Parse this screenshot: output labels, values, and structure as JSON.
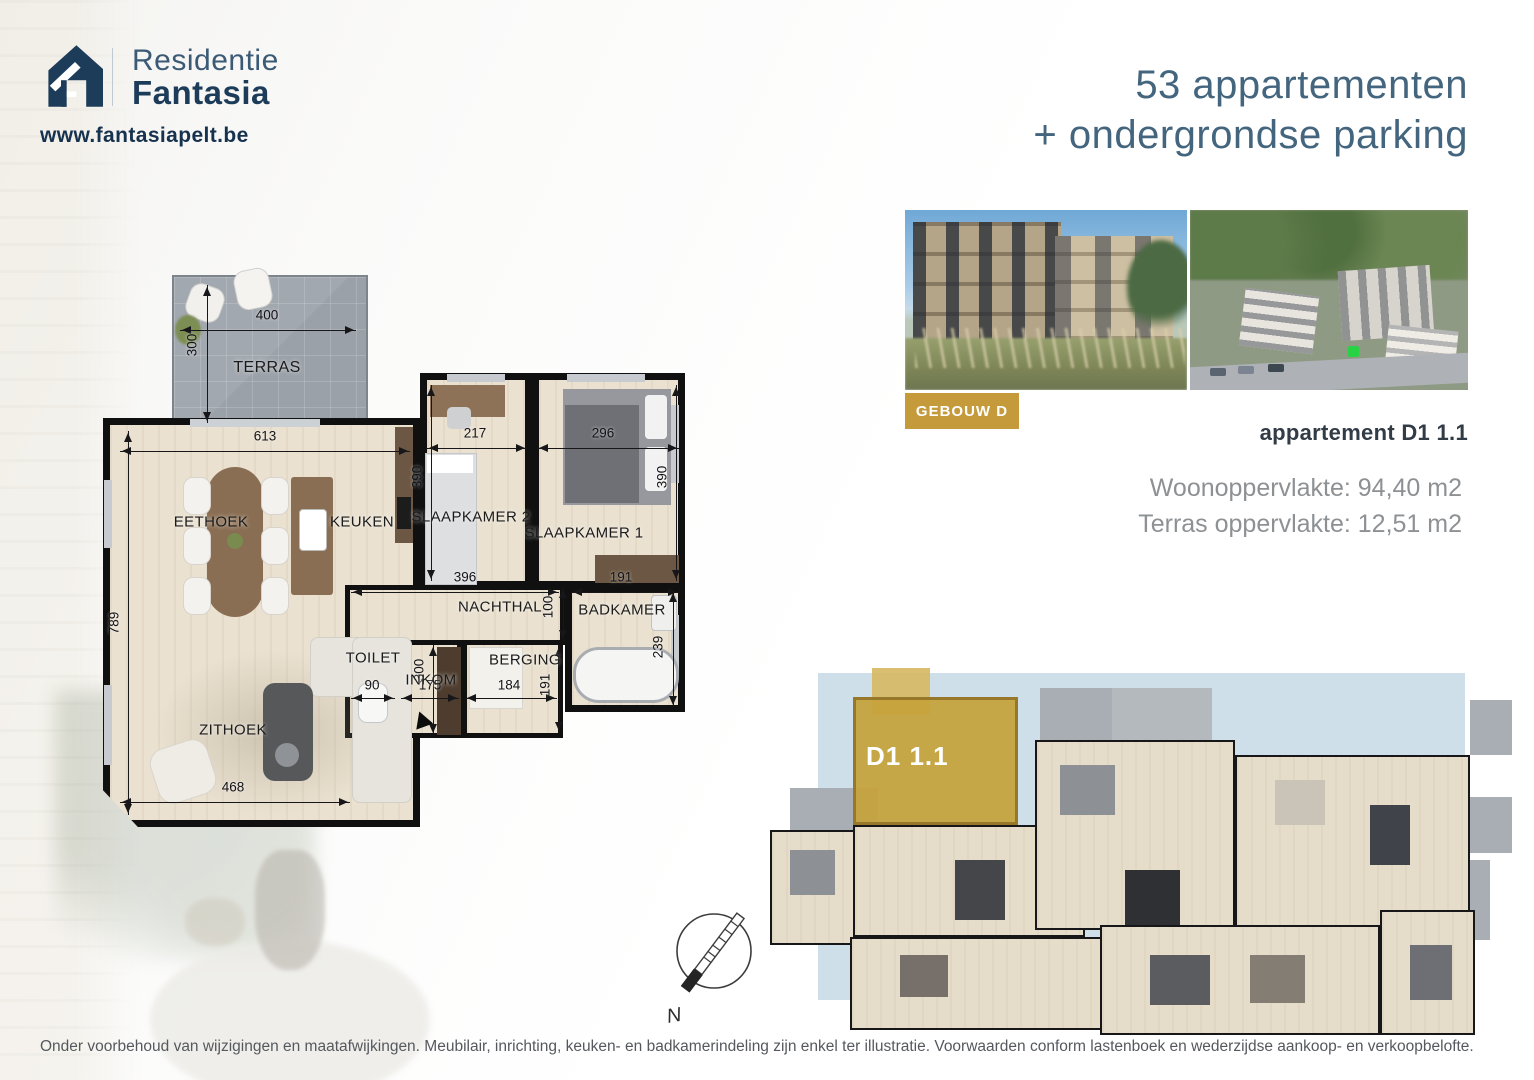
{
  "brand": {
    "line1": "Residentie",
    "line2": "Fantasia",
    "website": "www.fantasiapelt.be"
  },
  "header": {
    "line1": "53 appartementen",
    "line2": "+ ondergrondse parking"
  },
  "project": {
    "badge": "GEBOUW D",
    "title": "appartement D1 1.1",
    "living_area": "Woonoppervlakte: 94,40 m2",
    "terrace_area": "Terras oppervlakte: 12,51 m2"
  },
  "floorplan": {
    "rooms": {
      "terras": "TERRAS",
      "eethoek": "EETHOEK",
      "keuken": "KEUKEN",
      "slaapkamer2": "SLAAPKAMER 2",
      "slaapkamer1": "SLAAPKAMER 1",
      "nachthal": "NACHTHAL",
      "badkamer": "BADKAMER",
      "toilet": "TOILET",
      "inkom": "INKOM",
      "berging": "BERGING",
      "zithoek": "ZITHOEK"
    },
    "dims": {
      "terras_w": "400",
      "terras_d": "300",
      "living_w": "613",
      "living_d": "789",
      "slk2_w": "217",
      "slk2_d": "390",
      "slk1_w": "296",
      "slk1_d": "390",
      "nachthal_w": "396",
      "nachthal_d": "100",
      "badkamer_w": "191",
      "badkamer_d": "239",
      "inkom_d": "300",
      "toilet_w": "90",
      "inkom_w": "175",
      "berging_w": "184",
      "berging_d": "191",
      "zithoek_w": "468"
    }
  },
  "overview": {
    "unit_label": "D1 1.1"
  },
  "compass": {
    "label": "N"
  },
  "footer": {
    "disclaimer": "Onder voorbehoud van wijzigingen en maatafwijkingen. Meubilair, inrichting, keuken- en badkamerindeling zijn enkel ter illustratie. Voorwaarden conform lastenboek en wederzijdse aankoop- en verkoopbelofte."
  },
  "colors": {
    "navy": "#1d3c5a",
    "steel_blue": "#44657e",
    "gold": "#c49a3b",
    "overview_bg": "#cfdfe9",
    "floor": "#eae1d0",
    "wall": "#101010",
    "terrace_gray": "#9ba1a9",
    "text_gray": "#8d9194"
  }
}
